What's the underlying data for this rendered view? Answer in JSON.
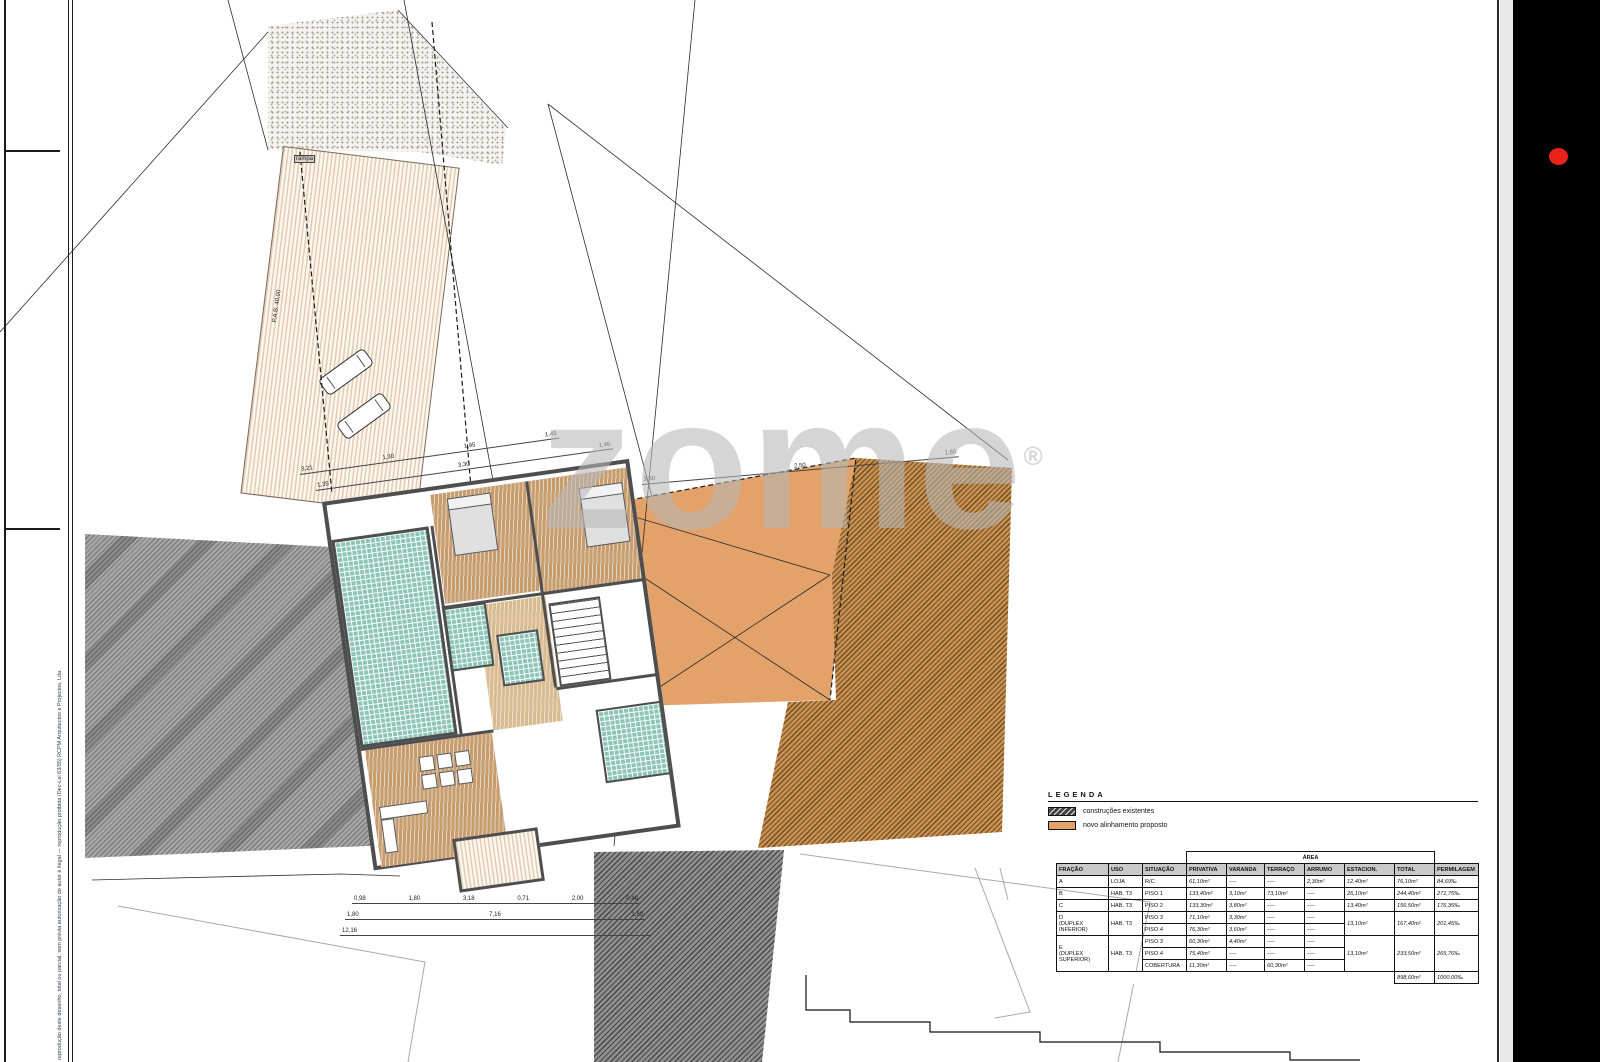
{
  "watermark": {
    "text": "zome",
    "reg": "®"
  },
  "side_notes": {
    "firm": "RCPM Arquitectos e Projectos, Lda.",
    "copyright": "reprodução deste desenho, total ou parcial, sem prévia autorização do autor é ilegal — reprodução proibida (Dec-Lei 63/85)"
  },
  "plan_labels": {
    "ramp": "rampa",
    "pab": "P.A.B. 40,00"
  },
  "dimensions": {
    "chains": [
      {
        "x": 300,
        "y": 468,
        "w": 262,
        "rot": -8,
        "vals": [
          "3,21",
          "1,30",
          "1,95",
          "1,45"
        ]
      },
      {
        "x": 316,
        "y": 484,
        "w": 300,
        "rot": -8,
        "vals": [
          "1,35",
          "3,30",
          "1,46"
        ]
      },
      {
        "x": 642,
        "y": 478,
        "w": 318,
        "rot": -5,
        "vals": [
          "3,50",
          "2,50",
          "1,65"
        ]
      },
      {
        "x": 352,
        "y": 897,
        "w": 288,
        "rot": 0,
        "vals": [
          "0,98",
          "1,80",
          "3,18",
          "0,71",
          "2,00",
          "0,48"
        ]
      },
      {
        "x": 345,
        "y": 913,
        "w": 300,
        "rot": 0,
        "vals": [
          "1,80",
          "7,16",
          "1,80"
        ]
      },
      {
        "x": 340,
        "y": 929,
        "w": 310,
        "rot": 0,
        "vals": [
          "12,16"
        ]
      }
    ]
  },
  "legend": {
    "title": "LEGENDA",
    "items": [
      {
        "swatch": "sw-hatch",
        "label": "construções existentes"
      },
      {
        "swatch": "sw-orange",
        "label": "novo alinhamento proposto"
      }
    ]
  },
  "area_table": {
    "area_header": "ÁREA",
    "columns": [
      "FRAÇÃO",
      "USO",
      "SITUAÇÃO",
      "PRIVATIVA",
      "VARANDA",
      "TERRAÇO",
      "ARRUMO",
      "ESTACION.",
      "TOTAL",
      "PERMILAGEM"
    ],
    "col_widths": [
      52,
      34,
      44,
      40,
      38,
      40,
      40,
      50,
      40,
      44
    ],
    "rows": [
      {
        "sep": true,
        "cells": [
          {
            "t": "A"
          },
          {
            "t": "LOJA"
          },
          {
            "t": "R/C"
          },
          {
            "t": "61,10m²",
            "cls": "num"
          },
          {
            "t": "----"
          },
          {
            "t": "----"
          },
          {
            "t": "2,30m²",
            "cls": "num"
          },
          {
            "t": "12,40m²",
            "cls": "num"
          },
          {
            "t": "76,10m²",
            "cls": "num"
          },
          {
            "t": "84,69‰",
            "cls": "num"
          }
        ]
      },
      {
        "sep": true,
        "cells": [
          {
            "t": "B"
          },
          {
            "t": "HAB. T3"
          },
          {
            "t": "PISO 1"
          },
          {
            "t": "133,40m²",
            "cls": "num"
          },
          {
            "t": "3,10m²",
            "cls": "num"
          },
          {
            "t": "73,10m²",
            "cls": "num"
          },
          {
            "t": "----"
          },
          {
            "t": "26,10m²",
            "cls": "num"
          },
          {
            "t": "244,40m²",
            "cls": "num"
          },
          {
            "t": "271,75‰",
            "cls": "num"
          }
        ]
      },
      {
        "sep": true,
        "cells": [
          {
            "t": "C"
          },
          {
            "t": "HAB. T3"
          },
          {
            "t": "PISO 2"
          },
          {
            "t": "133,30m²",
            "cls": "num"
          },
          {
            "t": "3,80m²",
            "cls": "num"
          },
          {
            "t": "----"
          },
          {
            "t": "----"
          },
          {
            "t": "13,40m²",
            "cls": "num"
          },
          {
            "t": "156,50m²",
            "cls": "num"
          },
          {
            "t": "176,35‰",
            "cls": "num"
          }
        ]
      },
      {
        "sep": true,
        "cells": [
          {
            "t": "D\n(DUPLEX INFERIOR)",
            "rs": 2
          },
          {
            "t": "HAB. T3",
            "rs": 2
          },
          {
            "t": "PISO 3"
          },
          {
            "t": "71,10m²",
            "cls": "num"
          },
          {
            "t": "3,30m²",
            "cls": "num"
          },
          {
            "t": "----"
          },
          {
            "t": "----"
          },
          {
            "t": "13,10m²",
            "rs": 2,
            "cls": "num span"
          },
          {
            "t": "167,40m²",
            "rs": 2,
            "cls": "num span"
          },
          {
            "t": "201,45‰",
            "rs": 2,
            "cls": "num span"
          }
        ]
      },
      {
        "cells": [
          {
            "t": "PISO 4"
          },
          {
            "t": "76,30m²",
            "cls": "num"
          },
          {
            "t": "3,60m²",
            "cls": "num"
          },
          {
            "t": "----"
          },
          {
            "t": "----"
          }
        ]
      },
      {
        "sep": true,
        "cells": [
          {
            "t": "E\n(DUPLEX SUPERIOR)",
            "rs": 3
          },
          {
            "t": "HAB. T3",
            "rs": 3
          },
          {
            "t": "PISO 3"
          },
          {
            "t": "60,30m²",
            "cls": "num"
          },
          {
            "t": "4,40m²",
            "cls": "num"
          },
          {
            "t": "----"
          },
          {
            "t": "----"
          },
          {
            "t": "13,10m²",
            "rs": 3,
            "cls": "num span"
          },
          {
            "t": "233,50m²",
            "rs": 3,
            "cls": "num span"
          },
          {
            "t": "265,76‰",
            "rs": 3,
            "cls": "num span"
          }
        ]
      },
      {
        "cells": [
          {
            "t": "PISO 4"
          },
          {
            "t": "75,40m²",
            "cls": "num"
          },
          {
            "t": "----"
          },
          {
            "t": "----"
          },
          {
            "t": "----"
          }
        ]
      },
      {
        "cells": [
          {
            "t": "COBERTURA"
          },
          {
            "t": "11,30m²",
            "cls": "num"
          },
          {
            "t": "----"
          },
          {
            "t": "60,30m²",
            "cls": "num"
          },
          {
            "t": "----"
          }
        ]
      }
    ],
    "footer": {
      "total": "898,60m²",
      "permilagem": "1000,00‰"
    }
  },
  "colors": {
    "existing_hatch": "#444444",
    "proposed_orange": "#e2a269",
    "terrace_teal": "#8cc5b4",
    "wood_floor": "#c79d6f",
    "wall_gray": "#4e4e4e",
    "record_dot_red": "#e8231a"
  }
}
